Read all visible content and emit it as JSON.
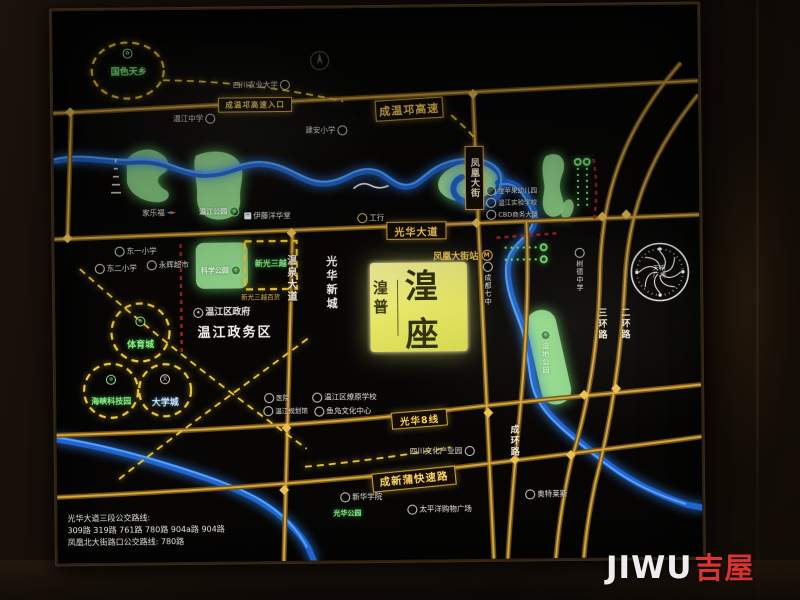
{
  "watermark": {
    "latin": "JIWU",
    "cn": "吉屋"
  },
  "icons": {
    "metro": "M",
    "university": "文",
    "government": "★",
    "flower": "✿",
    "sports": "⊕",
    "park": "⊕",
    "carrefour_left": "◄",
    "carrefour_right": "►"
  },
  "project": {
    "side": "湟普",
    "main": "湟座"
  },
  "station": "凤凰大街站",
  "roads": {
    "chengwenqiong": "成温邛高速",
    "entrance": "成温邛高速入口",
    "guanghua": "光华大道",
    "guanghua8": "光华8线",
    "chengxinpu": "成新蒲快速路",
    "fenghuang": "凤凰大街",
    "wenquan": "温泉大道",
    "sanhuan": "三环路",
    "erhuan": "二环路",
    "chenghuan": "成环路",
    "xincheng": "光华新城"
  },
  "pois": {
    "scau": "四川农业大学",
    "wenjiang_middle": "温江中学",
    "jianan": "建安小学",
    "carrefour": "家乐福",
    "ito": "伊藤洋华堂",
    "icbc": "工行",
    "dongyi": "东一小学",
    "donger": "东二小学",
    "yonghui": "永辉超市",
    "gov": "温江区政府",
    "district": "温江政务区",
    "qizhong": "成都七中",
    "shude": "树德中学",
    "apple": "金苹果幼儿园",
    "shiyan": "温江实验学校",
    "cbd": "CBD商务大厦",
    "liaoyuan": "温江区燎原学校",
    "yufu": "鱼凫文化中心",
    "hospital": "医院",
    "planning": "温江规划馆",
    "culture": "四川文化产业园",
    "xinhua": "新华学院",
    "pacific": "太平洋购物广场",
    "outlets": "奥特莱斯"
  },
  "zones": {
    "guose": "国色天乡",
    "sports": "体育城",
    "univ": "大学城",
    "haixia": "海峡科技园",
    "xinguang": "新光三越",
    "xinguang_sub": "新光三越百货",
    "wjpark": "温江公园",
    "science": "科学公园",
    "wetland": "湿地公园",
    "guanghua_park": "光华公园"
  },
  "landmark": {
    "top": "天府",
    "bottom": "广场"
  },
  "legend": {
    "line1": "光华大道三段公交路线:",
    "line2": "309路 319路 761路 780路 904a路 904路",
    "line3": "凤凰北大街路口公交路线: 780路"
  }
}
